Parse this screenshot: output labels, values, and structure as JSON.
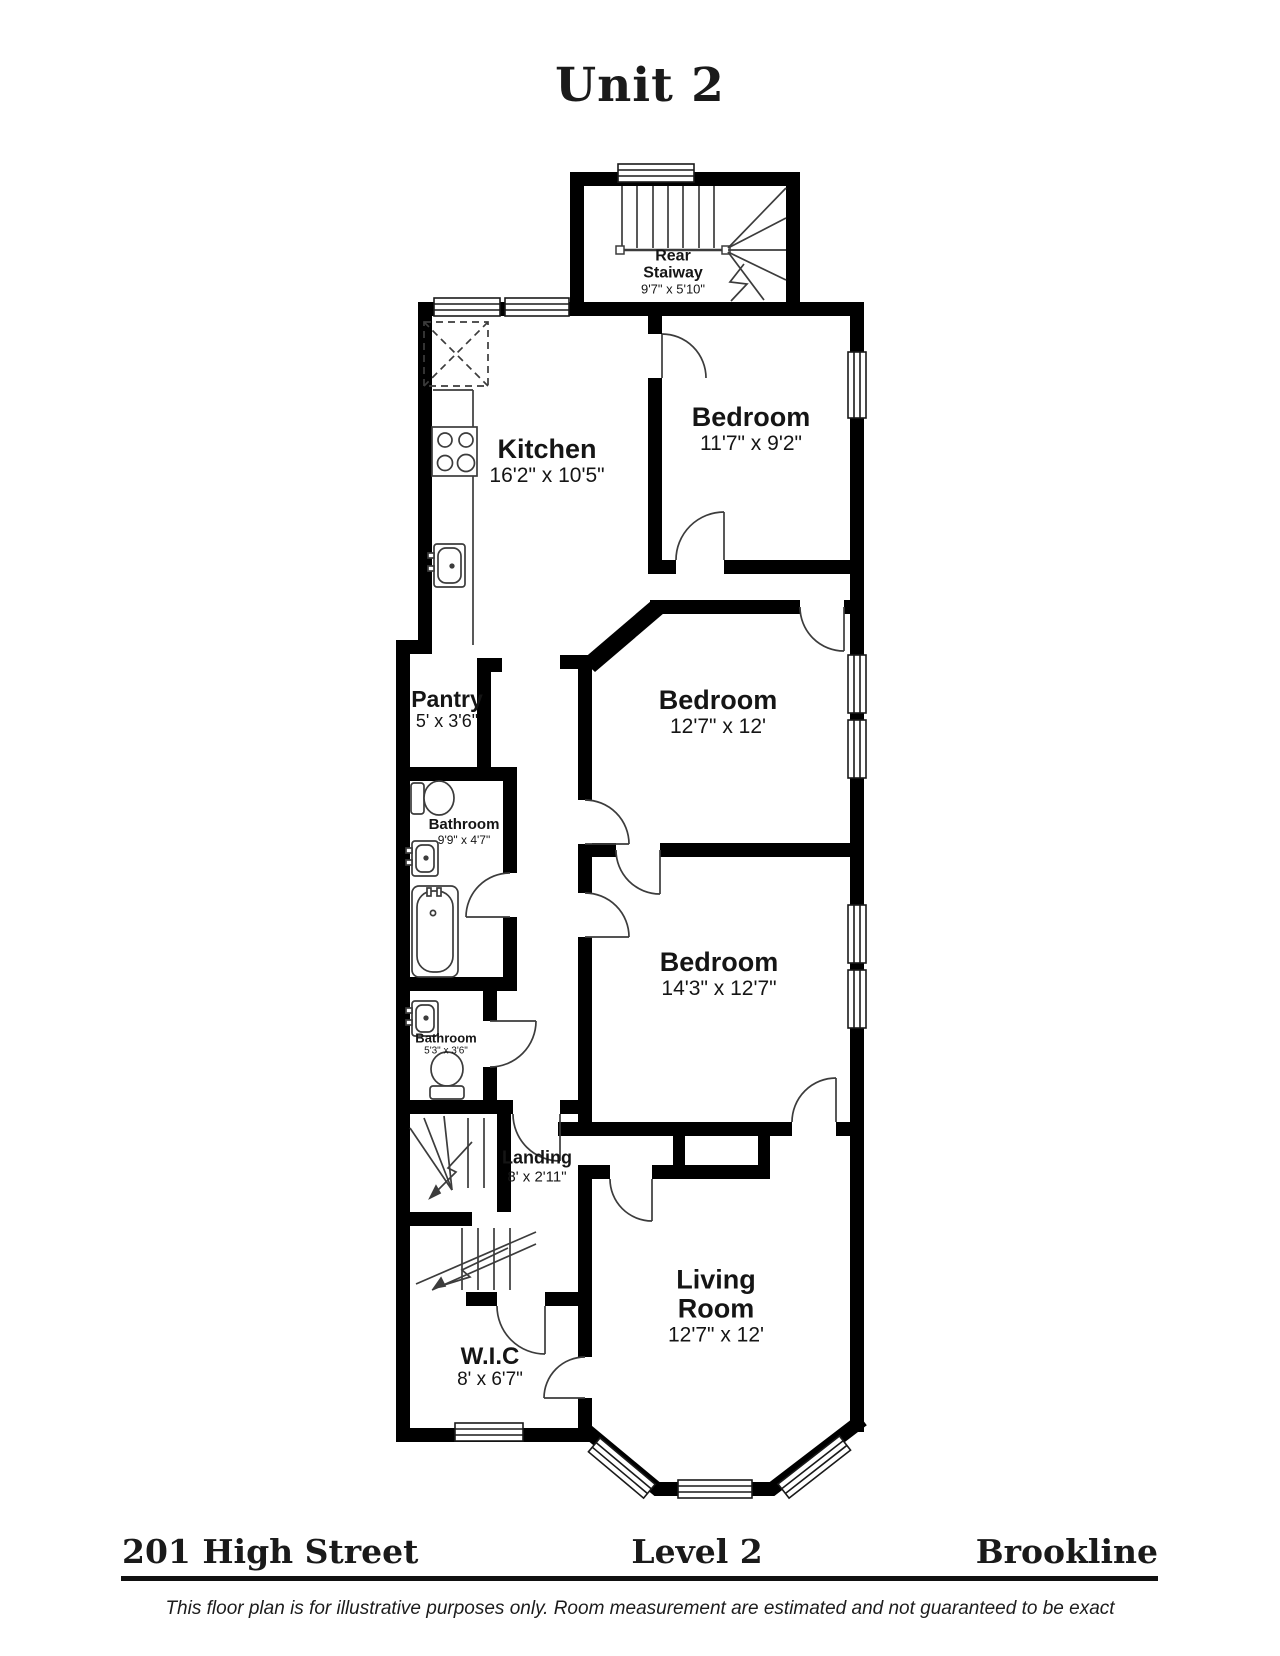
{
  "title": "Unit 2",
  "rooms": [
    {
      "id": "rear-stairway",
      "name": "Rear\nStaiway",
      "dims": "9'7\" x 5'10\""
    },
    {
      "id": "kitchen",
      "name": "Kitchen",
      "dims": "16'2\" x 10'5\""
    },
    {
      "id": "bedroom-1",
      "name": "Bedroom",
      "dims": "11'7\" x 9'2\""
    },
    {
      "id": "pantry",
      "name": "Pantry",
      "dims": "5' x 3'6\""
    },
    {
      "id": "bedroom-2",
      "name": "Bedroom",
      "dims": "12'7\" x 12'"
    },
    {
      "id": "bathroom-1",
      "name": "Bathroom",
      "dims": "9'9\" x 4'7\""
    },
    {
      "id": "bedroom-3",
      "name": "Bedroom",
      "dims": "14'3\" x 12'7\""
    },
    {
      "id": "bathroom-2",
      "name": "Bathroom",
      "dims": "5'3\" x 3'6\""
    },
    {
      "id": "landing",
      "name": "Landing",
      "dims": "8' x 2'11\""
    },
    {
      "id": "wic",
      "name": "W.I.C",
      "dims": "8' x 6'7\""
    },
    {
      "id": "living-room",
      "name": "Living\nRoom",
      "dims": "12'7\" x 12'"
    }
  ],
  "footer": {
    "address": "201 High Street",
    "level": "Level 2",
    "city": "Brookline"
  },
  "disclaimer": "This floor plan is for illustrative purposes only.  Room measurement are estimated and not guaranteed to be exact",
  "colors": {
    "wall": "#000000",
    "thin_line": "#3c3c3c",
    "background": "#ffffff"
  }
}
